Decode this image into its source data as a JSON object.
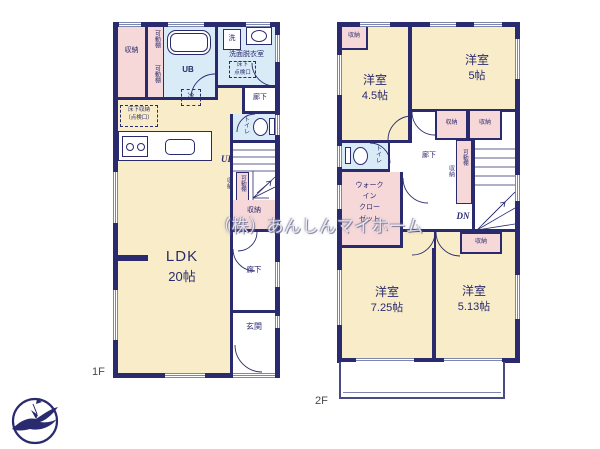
{
  "colors": {
    "wall": "#2a2a6e",
    "room_fill": "#f8ecc9",
    "closet_fill": "#f7d8d8",
    "wet_area_fill": "#d9ebf6",
    "window_line": "#7d87ad"
  },
  "watermark": "（株）あんしんマイホーム",
  "logo_icon": "bird-in-circle-logo",
  "floor1": {
    "label": "1F",
    "rooms": {
      "ldk_name": "LDK",
      "ldk_size": "20帖",
      "closet_nw": "収納",
      "shelf_top": "可動棚",
      "shelf_bottom": "可動棚",
      "bath": "UB",
      "washer": "洗",
      "washroom": "洗面脱衣室",
      "inspection_hatch": "床下\n点検口",
      "fridge": "冷",
      "hall_upper": "廊下",
      "toilet": "トイレ",
      "underfloor_storage": "床下収納\n（点検口）",
      "up": "UP",
      "stair_closet": "収納",
      "stair_shelf": "可動棚",
      "closet_mid": "収納",
      "hall_lower": "廊下",
      "entrance": "玄関"
    }
  },
  "floor2": {
    "label": "2F",
    "rooms": {
      "room_nw_name": "洋室",
      "room_nw_size": "4.5帖",
      "room_nw_closet": "収納",
      "room_ne_name": "洋室",
      "room_ne_size": "5帖",
      "closet_a": "収納",
      "closet_b": "収納",
      "toilet": "トイレ",
      "hall": "廊下",
      "stair_closet": "収納",
      "stair_shelf": "可動棚",
      "dn": "DN",
      "wic": "ウォーク\nイン\nクロー\nゼット",
      "closet_c": "収納",
      "room_sw_name": "洋室",
      "room_sw_size": "7.25帖",
      "room_se_name": "洋室",
      "room_se_size": "5.13帖"
    }
  }
}
